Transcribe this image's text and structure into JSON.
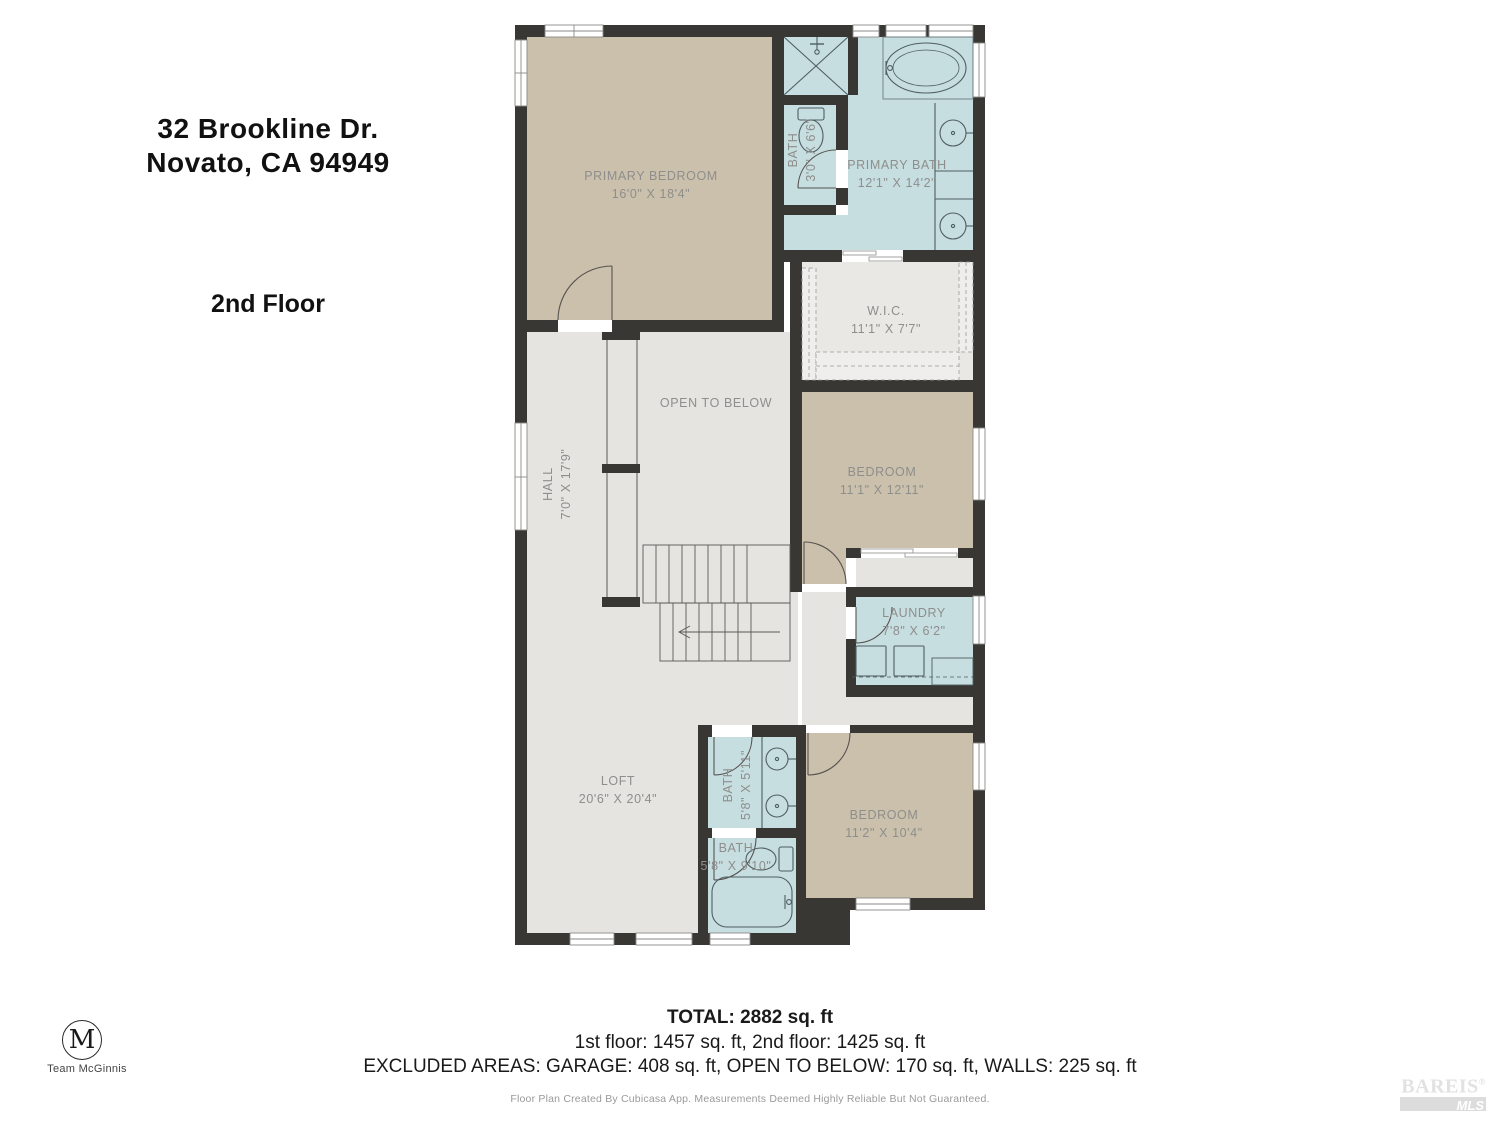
{
  "header": {
    "address_line1": "32 Brookline Dr.",
    "address_line2": "Novato, CA 94949",
    "floor_label": "2nd Floor"
  },
  "rooms": [
    {
      "id": "primary-bedroom",
      "name": "PRIMARY BEDROOM",
      "dims": "16'0\" X 18'4\""
    },
    {
      "id": "bath-small",
      "name": "BATH",
      "dims": "3'0\" X 6'6\""
    },
    {
      "id": "primary-bath",
      "name": "PRIMARY BATH",
      "dims": "12'1\" X 14'2\""
    },
    {
      "id": "wic",
      "name": "W.I.C.",
      "dims": "11'1\" X 7'7\""
    },
    {
      "id": "open-to-below",
      "name": "OPEN TO BELOW",
      "dims": ""
    },
    {
      "id": "hall",
      "name": "HALL",
      "dims": "7'0\" X 17'9\""
    },
    {
      "id": "bedroom-1",
      "name": "BEDROOM",
      "dims": "11'1\" X 12'11\""
    },
    {
      "id": "laundry",
      "name": "LAUNDRY",
      "dims": "7'8\" X 6'2\""
    },
    {
      "id": "loft",
      "name": "LOFT",
      "dims": "20'6\" X 20'4\""
    },
    {
      "id": "bath-upper",
      "name": "BATH",
      "dims": "5'8\" X 5'11\""
    },
    {
      "id": "bath-lower",
      "name": "BATH",
      "dims": "5'8\" X 9'10\""
    },
    {
      "id": "bedroom-2",
      "name": "BEDROOM",
      "dims": "11'2\" X 10'4\""
    }
  ],
  "footer": {
    "total": "TOTAL: 2882 sq. ft",
    "floors": "1st floor: 1457 sq. ft, 2nd floor: 1425 sq. ft",
    "excluded": "EXCLUDED AREAS: GARAGE: 408 sq. ft, OPEN TO BELOW: 170 sq. ft, WALLS: 225 sq. ft",
    "disclaimer": "Floor Plan Created By Cubicasa App. Measurements Deemed Highly Reliable But Not Guaranteed."
  },
  "branding": {
    "logo_letter": "M",
    "logo_name": "Team McGinnis",
    "watermark_line1": "BAREIS",
    "watermark_reg": "®",
    "watermark_line2": "MLS"
  },
  "colors": {
    "wall": "#393734",
    "floor_tan": "#cbc0ab",
    "floor_blue": "#c7dee1",
    "floor_gray": "#e5e4e1",
    "floor_wic": "#e9e8e5",
    "label_text": "#8e8e8c"
  }
}
